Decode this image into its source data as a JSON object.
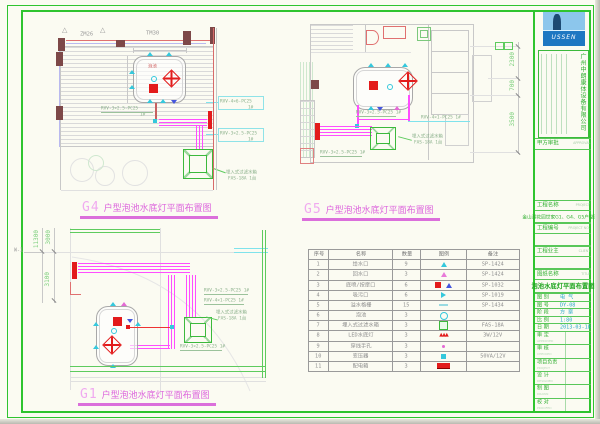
{
  "sheet": {
    "bg": "#fbfbf2",
    "frame_color": "#2fc42f"
  },
  "titles": {
    "g4_code": "G4",
    "g5_code": "G5",
    "g1_code": "G1",
    "suffix": "户型泡池水底灯平面布置图"
  },
  "g4": {
    "door_label": "ZM26",
    "window_label": "TM30",
    "pool_label": "泡池",
    "cable_bottom": "RVV-3×2.5-PC25",
    "cable_bottom_tag": "1#",
    "cable_right_top": "RVV-4×6-PC25",
    "cable_right_top_tag": "1#",
    "cable_right_bot": "RVV-3×2.5-PC25",
    "cable_right_bot_tag": "1#",
    "filter_line1": "埋入式过滤水箱",
    "filter_line2": "FAS-18A  1台"
  },
  "g5": {
    "cable_pool": "RVV-3×2.5-PC25  1#",
    "cable_right": "RVV-4×1-PC25  1#",
    "cable_bottom": "RVV-3×2.5-PC25  1#",
    "filter_line1": "埋入式过滤水箱",
    "filter_line2": "FAS-18A  1台",
    "dim_1": "2300",
    "dim_2": "700",
    "dim_3": "3500"
  },
  "g1": {
    "dim_total": "11300",
    "dim_a": "3000",
    "dim_b": "3100",
    "grid_ref": "W-1",
    "cable1": "RVV-3×2.5-PC25  1#",
    "cable2": "RVV-4×1-PC25  1#",
    "cable3": "RVV-3×2.5-PC25  1#",
    "filter_line1": "埋入式过滤水箱",
    "filter_line2": "FAS-18A  1台"
  },
  "legend_table": {
    "headers": [
      "序号",
      "名称",
      "数量",
      "图例",
      "备注"
    ],
    "rows": [
      {
        "no": "1",
        "name": "给水口",
        "qty": "9",
        "symbol": "cyan-triangle",
        "remark": "SP-1424"
      },
      {
        "no": "2",
        "name": "回水口",
        "qty": "3",
        "symbol": "magenta-triangle",
        "remark": "SP-1424"
      },
      {
        "no": "3",
        "name": "底喷/按摩口",
        "qty": "6",
        "symbol": "red-square-blue-triangle",
        "remark": "SP-1032"
      },
      {
        "no": "4",
        "name": "吸污口",
        "qty": "6",
        "symbol": "cyan-play",
        "remark": "SP-1019"
      },
      {
        "no": "5",
        "name": "溢水格栅",
        "qty": "15",
        "symbol": "cyan-dash",
        "remark": "SP-1434"
      },
      {
        "no": "6",
        "name": "泡池",
        "qty": "3",
        "symbol": "cyan-circle",
        "remark": ""
      },
      {
        "no": "7",
        "name": "埋入式过滤水箱",
        "qty": "3",
        "symbol": "green-square",
        "remark": "FAS-18A"
      },
      {
        "no": "8",
        "name": "LED水底灯",
        "qty": "3",
        "symbol": "red-star",
        "remark": "3W/12V"
      },
      {
        "no": "9",
        "name": "穿线手孔",
        "qty": "3",
        "symbol": "magenta-dot",
        "remark": ""
      },
      {
        "no": "10",
        "name": "变压器",
        "qty": "3",
        "symbol": "cyan-filled-square",
        "remark": "50VA/12V"
      },
      {
        "no": "11",
        "name": "配电箱",
        "qty": "3",
        "symbol": "red-filled-rect",
        "remark": ""
      }
    ]
  },
  "title_block": {
    "logo_text": "USSEN",
    "company_name": "广州中朗康体设备有限公司",
    "approval_label": "甲方审批",
    "approval_value": "APPROVAL",
    "project_label": "工程名称",
    "project_en": "PROJECT",
    "project_name": "金山湖花园世家G1、G4、G5户型泡池",
    "number_label": "工程编号",
    "number_en": "PROJECT NO.",
    "client_label": "工程业主",
    "client_en": "CLIENT",
    "title_label": "图纸名称",
    "title_en": "TITLE",
    "drawing_title": "泡池水底灯平面布置图",
    "info_rows": [
      {
        "label": "图 别",
        "value": "电 气"
      },
      {
        "label": "图 号",
        "value": "DY-08"
      },
      {
        "label": "阶 段",
        "value": "方 案"
      },
      {
        "label": "比 例",
        "value": "1:80"
      },
      {
        "label": "日 期",
        "value": "2013-03-18"
      }
    ],
    "sign_rows": [
      {
        "label": "审 定",
        "sub": "APPROVED"
      },
      {
        "label": "审 核",
        "sub": "CHECKED"
      },
      {
        "label": "项目负责",
        "sub": "PROJECT"
      },
      {
        "label": "设 计",
        "sub": "DESIGNED"
      },
      {
        "label": "制 图",
        "sub": "DRAWN"
      },
      {
        "label": "校 对",
        "sub": "PROOFED"
      }
    ]
  }
}
